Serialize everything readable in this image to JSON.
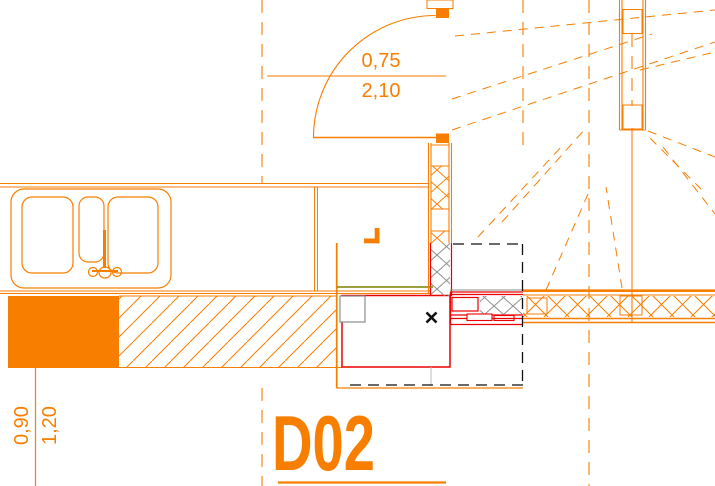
{
  "drawing_type": "architectural-plan-detail",
  "labels": {
    "detail_code": "D02"
  },
  "dimensions": {
    "door_width_m": "0,75",
    "door_height_m": "2,10",
    "wall_offset_inner_m": "0,90",
    "wall_offset_outer_m": "1,20"
  },
  "colors": {
    "line_primary": "#F87E00",
    "section_red": "#EC0000",
    "hatch_gray": "#8C8C8C",
    "finish_olive": "#7A8000",
    "marker_black": "#111111",
    "background": "#FFFFFF"
  }
}
